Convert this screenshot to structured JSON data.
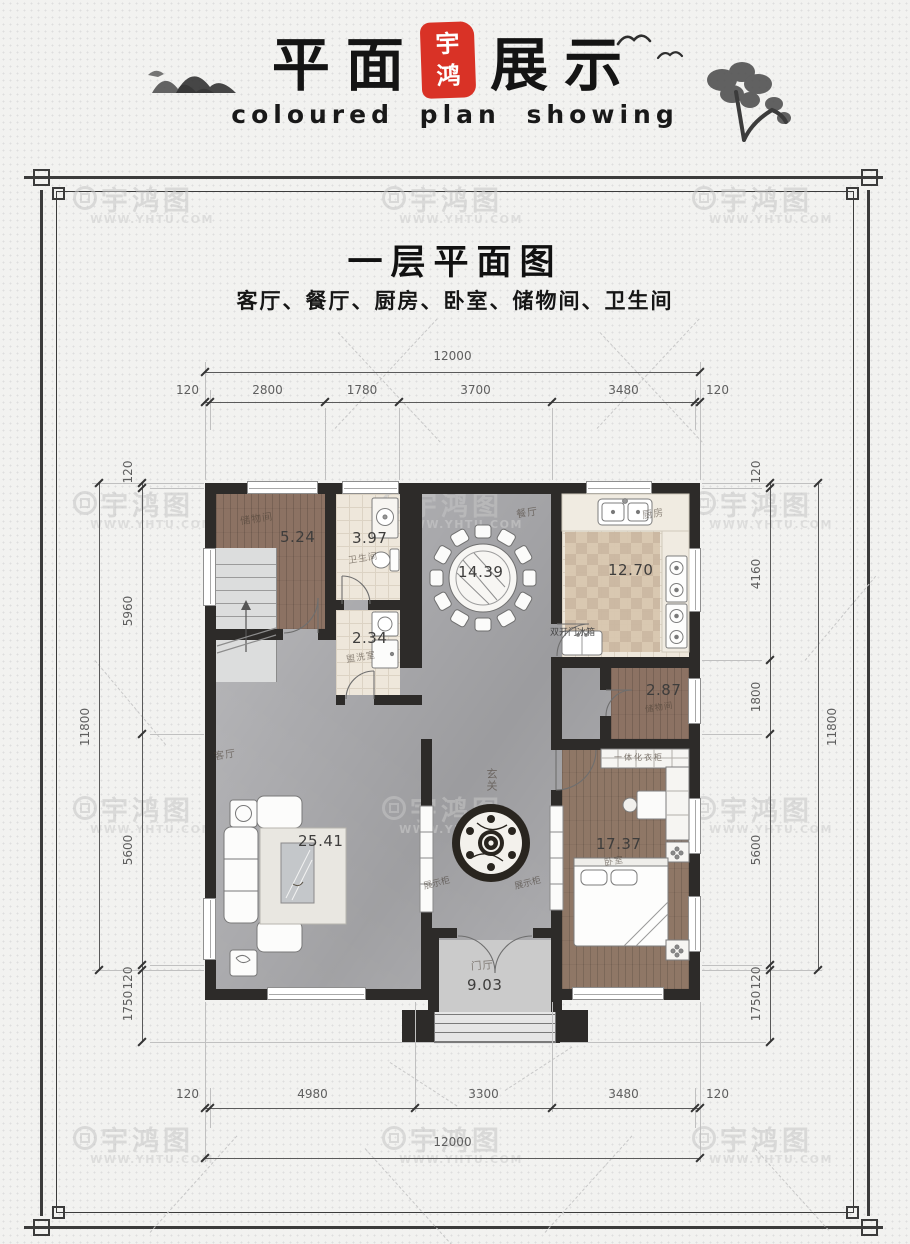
{
  "header": {
    "title_left": "平面",
    "seal_top": "宇",
    "seal_bottom": "鸿",
    "title_right": "展示",
    "subtitle_en": "coloured plan showing",
    "seal_color": "#d93226"
  },
  "plan": {
    "title": "一层平面图",
    "subtitle": "客厅、餐厅、厨房、卧室、储物间、卫生间"
  },
  "dimensions": {
    "top": {
      "overall": "12000",
      "segments": [
        "120",
        "2800",
        "1780",
        "3700",
        "3480",
        "120"
      ]
    },
    "bottom": {
      "overall": "12000",
      "segments": [
        "120",
        "4980",
        "3300",
        "3480",
        "120"
      ]
    },
    "left": {
      "overall": "11800",
      "segments": [
        "120",
        "5960",
        "5600",
        "120",
        "1750"
      ]
    },
    "right": {
      "overall": "11800",
      "segments": [
        "120",
        "4160",
        "1800",
        "5600",
        "120",
        "1750"
      ]
    }
  },
  "rooms": {
    "storage1": {
      "name": "储物间",
      "area": "5.24"
    },
    "bath": {
      "name": "卫生间",
      "area": "3.97"
    },
    "laundry": {
      "name": "盥洗室",
      "area": "2.34"
    },
    "dining": {
      "name": "餐厅",
      "area": "14.39"
    },
    "kitchen": {
      "name": "厨房",
      "area": "12.70"
    },
    "storage2": {
      "name": "储物间",
      "area": "2.87"
    },
    "living": {
      "name": "客厅",
      "area": "25.41"
    },
    "foyer": {
      "name": "玄关"
    },
    "bedroom": {
      "name": "卧室",
      "area": "17.37"
    },
    "entry": {
      "name": "门厅",
      "area": "9.03"
    }
  },
  "furniture_labels": {
    "fridge": "双开门冰箱",
    "wardrobe": "一体化衣柜",
    "cabinet_left": "展示柜",
    "cabinet_right": "展示柜"
  },
  "watermark": {
    "brand": "宇鸿图",
    "url": "WWW.YHTU.COM"
  }
}
